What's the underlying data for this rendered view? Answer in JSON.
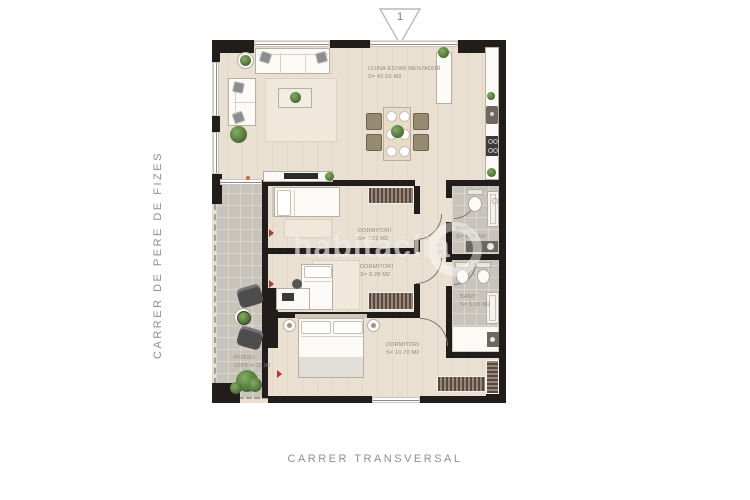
{
  "marker": {
    "number": "1"
  },
  "streets": {
    "left": "CARRER DE PERE DE FIZES",
    "bottom": "CARRER TRANSVERSAL"
  },
  "watermark": {
    "text": "habitaclia"
  },
  "rooms": {
    "living": {
      "name": "CUINA ESTAR MENJADOR",
      "area": "S= 43.50 m2"
    },
    "bedroom1": {
      "name": "DORMITORI",
      "area": "S= 7.72 m2"
    },
    "bedroom2": {
      "name": "DORMITORI",
      "area": "S= 9.28 m2"
    },
    "bedroom3": {
      "name": "DORMITORI",
      "area": "S= 10.70 m2"
    },
    "bath1": {
      "name": "BANY",
      "area": "S= 4.35 m2"
    },
    "bath2": {
      "name": "BANY",
      "area": "S= 5.00 m2"
    },
    "porch": {
      "name": "PORXO",
      "area": "100% = 10.00"
    }
  },
  "colors": {
    "wall": "#201d1a",
    "wood_floor": "#e9e0d2",
    "tile_floor": "#c9c4bb",
    "plant_green": "#42672f",
    "accent_red": "#b03a2e",
    "label_gray": "#8f897f"
  }
}
